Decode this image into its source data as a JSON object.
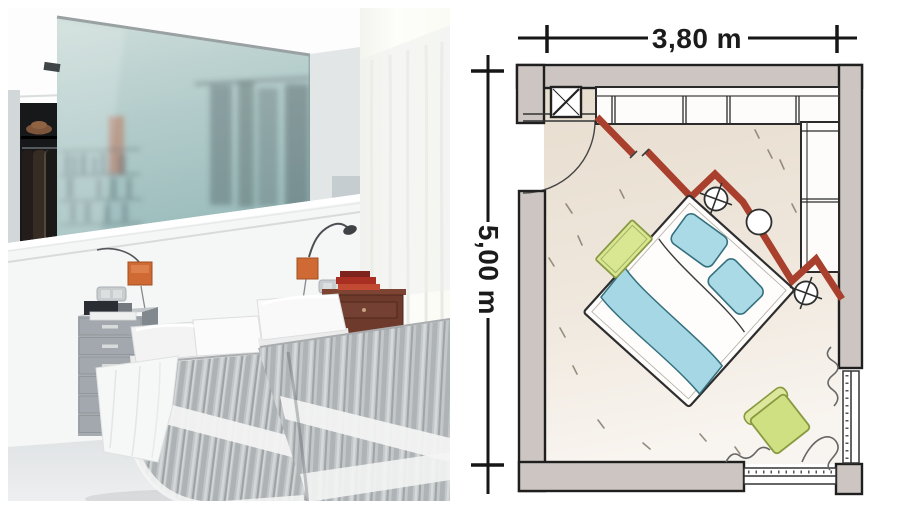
{
  "composite": {
    "left_panel": "bedroom photograph",
    "right_panel": "bedroom floor plan sketch"
  },
  "floor_plan": {
    "width_label": "3,80 m",
    "height_label": "5,00 m",
    "colors": {
      "wall_fill": "#ccc5c1",
      "partition_red": "#a8402d",
      "floor_top": "#e7ddcf",
      "floor_bottom": "#f8f4ef",
      "bed_blue": "#a9dae6",
      "accent_green": "#d9e692",
      "outline": "#222222"
    },
    "elements": [
      "exterior-walls",
      "entry-door-swing",
      "column-symbol",
      "wardrobe-top-wall",
      "wardrobe-right-wall",
      "red-diagonal-partition",
      "double-bed",
      "pillows",
      "blanket",
      "bedside-light-symbol-left",
      "bedside-light-symbol-right",
      "round-side-table",
      "green-bench",
      "green-pouf",
      "window-bottom-wall",
      "window-right-wall",
      "curtain-scribbles",
      "floor-texture-marks"
    ]
  },
  "photo": {
    "colors": {
      "frosted_glass": "#aec7c4",
      "lamp_orange": "#cf6a35",
      "bedspread_grey": "#c1c5c7",
      "nightstand_wood": "#6e3a2b",
      "books_red": "#a92f23",
      "floor_grey": "#e4e7e9"
    },
    "elements": [
      "ceiling",
      "recessed-spotlight",
      "open-closet",
      "hat",
      "clothes-rail",
      "coats",
      "frosted-glass-partition",
      "bookshelf-silhouette",
      "headboard-half-wall",
      "wall-lamp-left",
      "wall-lamp-right",
      "light-switch-left",
      "light-switch-right",
      "power-cable",
      "metal-drawer-unit",
      "books-on-drawer-unit",
      "twin-bed-left",
      "twin-bed-right",
      "white-pillows",
      "striped-bedspread",
      "draped-sheet",
      "wooden-nightstand",
      "red-books",
      "window-with-sheer-curtain",
      "light-grey-floor"
    ]
  }
}
